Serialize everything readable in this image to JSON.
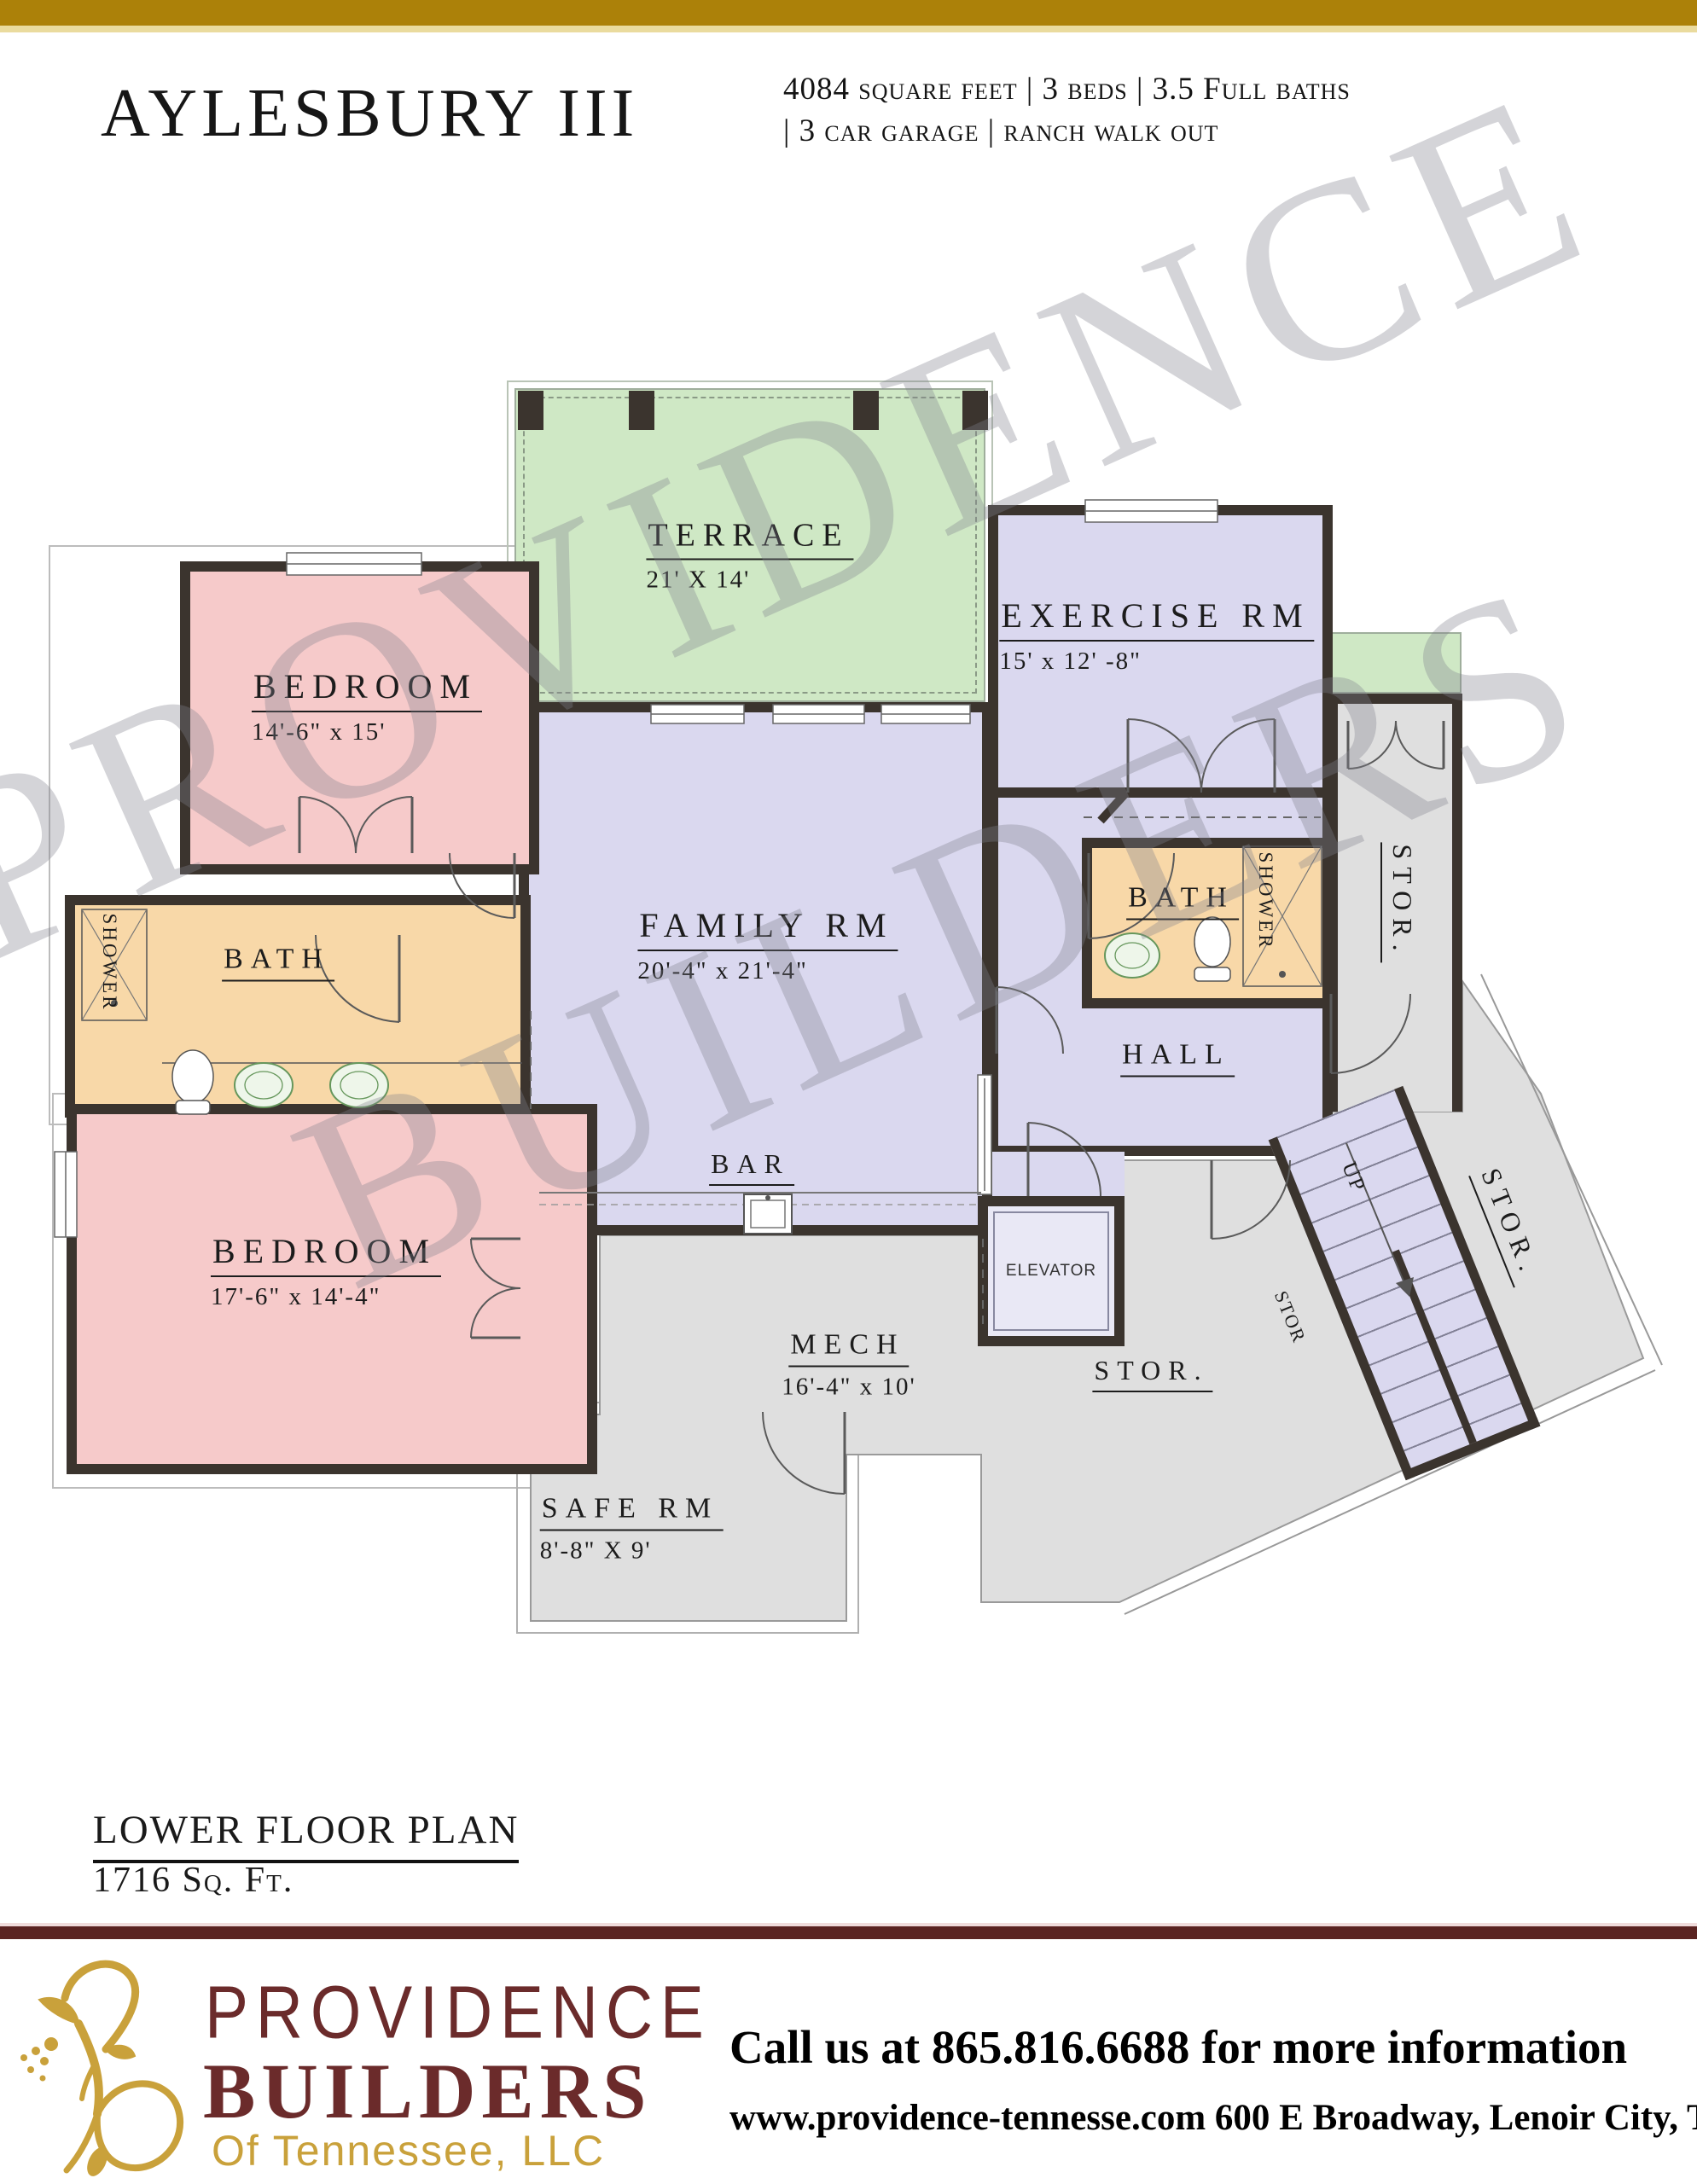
{
  "header": {
    "title": "AYLESBURY III",
    "specs_line1": "4084 square feet | 3 beds | 3.5 Full baths",
    "specs_line2": "| 3 car garage | ranch walk out"
  },
  "plan": {
    "watermark_line1": "PROVIDENCE",
    "watermark_line2": "BUILDERS",
    "rooms": {
      "terrace": {
        "name": "TERRACE",
        "dims": "21' X 14'"
      },
      "exercise": {
        "name": "EXERCISE RM",
        "dims": "15' x 12' -8\""
      },
      "bedroom_upper": {
        "name": "BEDROOM",
        "dims": "14'-6\" x 15'"
      },
      "bedroom_lower": {
        "name": "BEDROOM",
        "dims": "17'-6\" x 14'-4\""
      },
      "family": {
        "name": "FAMILY RM",
        "dims": "20'-4\" x 21'-4\""
      },
      "bath_left": {
        "name": "BATH"
      },
      "bath_right": {
        "name": "BATH"
      },
      "shower_left": {
        "label": "SHOWER"
      },
      "shower_right": {
        "label": "SHOWER"
      },
      "hall": {
        "name": "HALL"
      },
      "bar": {
        "name": "BAR"
      },
      "mech": {
        "name": "MECH",
        "dims": "16'-4\" x 10'"
      },
      "safe": {
        "name": "SAFE RM",
        "dims": "8'-8\" X 9'"
      },
      "stor_center": {
        "name": "STOR."
      },
      "stor_vertical": {
        "name": "STOR."
      },
      "stor_diagonal": {
        "name": "STOR."
      },
      "stor_under_stairs": {
        "label": "STOR"
      },
      "elevator": {
        "label": "ELEVATOR"
      },
      "stairs": {
        "up_label": "UP"
      }
    }
  },
  "caption": {
    "title": "LOWER FLOOR PLAN",
    "subtitle": "1716 Sq. Ft."
  },
  "footer": {
    "brand_line1": "PROVIDENCE",
    "brand_line2": "BUILDERS",
    "brand_line3": "Of Tennessee, LLC",
    "phone_line": "Call us at 865.816.6688 for more information",
    "address_line": "www.providence-tennesse.com 600 E Broadway, Lenoir City, TN 37771"
  },
  "colors": {
    "wall": "#3b342e",
    "pink": "#f6caca",
    "lavender": "#dad8ef",
    "tan": "#f8d8a8",
    "green": "#cfe8c5",
    "gray": "#dfdfdf",
    "gold_bar": "#ac8109",
    "gold_bar_light": "#eadb9e",
    "maroon": "#5a2321",
    "brand_maroon": "#6b2b2b",
    "brand_gold": "#c9a13b",
    "watermark": "rgba(128,128,142,0.34)"
  }
}
